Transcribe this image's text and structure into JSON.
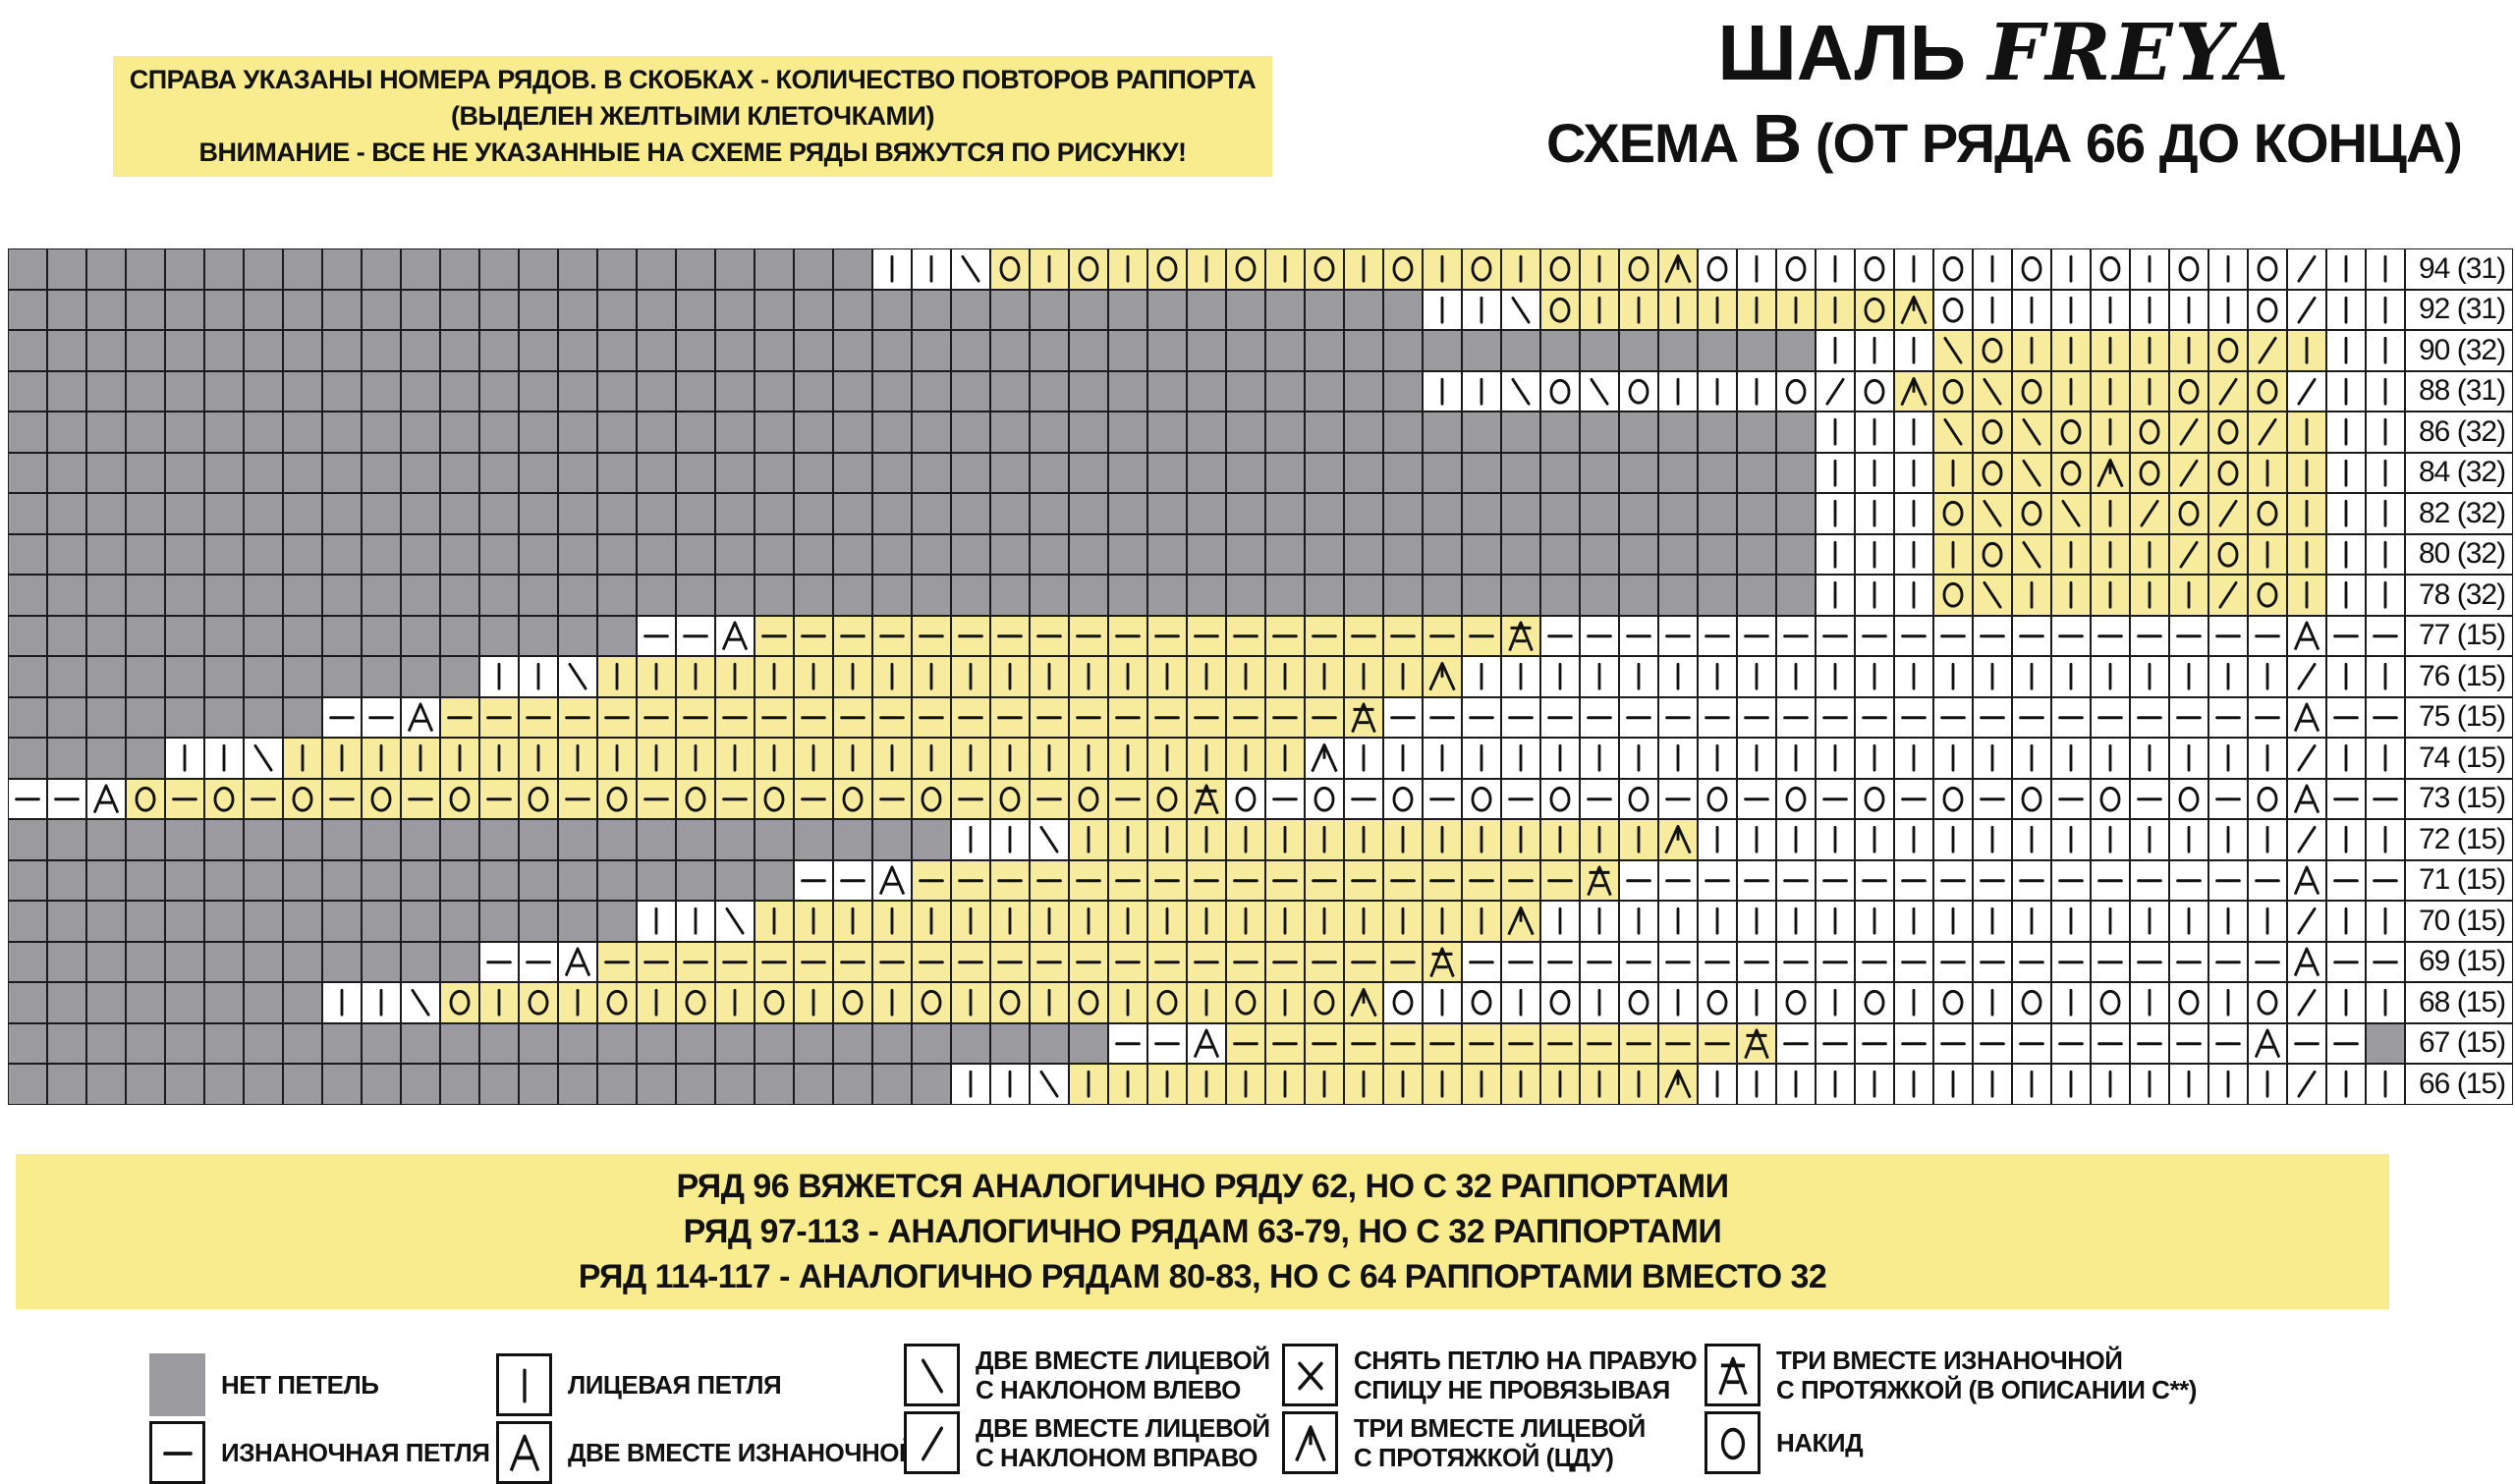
{
  "title": {
    "shawl_prefix": "ШАЛЬ ",
    "shawl_name": "FREYA",
    "scheme_pre": "СХЕМА ",
    "scheme_letter": "В",
    "scheme_post": " (ОТ РЯДА 66 ДО КОНЦА)"
  },
  "note_top": {
    "lines": [
      "СПРАВА УКАЗАНЫ НОМЕРА РЯДОВ. В СКОБКАХ - КОЛИЧЕСТВО ПОВТОРОВ РАППОРТА",
      "(ВЫДЕЛЕН ЖЕЛТЫМИ КЛЕТОЧКАМИ)",
      "ВНИМАНИЕ - ВСЕ НЕ УКАЗАННЫЕ НА СХЕМЕ РЯДЫ ВЯЖУТСЯ ПО РИСУНКУ!"
    ]
  },
  "note_bottom": {
    "lines": [
      "РЯД 96 ВЯЖЕТСЯ АНАЛОГИЧНО РЯДУ 62, НО С 32 РАППОРТАМИ",
      "РЯД 97-113 - АНАЛОГИЧНО РЯДАМ 63-79, НО С 32 РАППОРТАМИ",
      "РЯД 114-117 - АНАЛОГИЧНО РЯДАМ 80-83, НО С 64 РАППОРТАМИ ВМЕСТО 32"
    ]
  },
  "colors": {
    "rapport_yellow": "#f7eb9e",
    "note_yellow": "#f8ec8e",
    "no_stitch_gray": "#9b9a9e",
    "grid_line": "#1b1b1b"
  },
  "chart_data": {
    "type": "table",
    "description": "Lace knitting chart, schema B of shawl FREYA, rows 66-94. Each row: 61 cells left-to-right plus row label. Symbols: G=no-stitch(gray), k=knit, p=purl, o=yarn-over, l=k2tog-left, r=k2tog-right, a=p2tog, c=sl1-k2tog-psso(CDD), e=p3tog-with-slip, x=slip-stitch. 'yellow' = inclusive column range of the highlighted rapport.",
    "columns": 61,
    "symbol_key": {
      "G": "no-stitch",
      "k": "knit",
      "p": "purl",
      "o": "yarn-over",
      "l": "k2tog-left-leaning",
      "r": "k2tog-right-leaning",
      "a": "p2tog",
      "c": "cdd-3tog-knit",
      "e": "p3tog-with-slip",
      "x": "slip-stitch"
    },
    "rows": [
      {
        "label": "94 (31)",
        "yellow": [
          25,
          42
        ],
        "cells": "GGGGGGGGGGGGGGGGGGGGGGkklokokokokokokokokocokokokokokokokorkk"
      },
      {
        "label": "92 (31)",
        "yellow": [
          39,
          48
        ],
        "cells": "GGGGGGGGGGGGGGGGGGGGGGGGGGGGGGGGGGGGkklokkkkkkkocokkkkkkkorkk"
      },
      {
        "label": "90 (32)",
        "yellow": [
          49,
          58
        ],
        "cells": "GGGGGGGGGGGGGGGGGGGGGGGGGGGGGGGGGGGGGGGGGGGGGGkkklokkkkkorkkk"
      },
      {
        "label": "88 (31)",
        "yellow": [
          48,
          57
        ],
        "cells": "GGGGGGGGGGGGGGGGGGGGGGGGGGGGGGGGGGGGkklolokkkorocolokkkororkk"
      },
      {
        "label": "86 (32)",
        "yellow": [
          49,
          58
        ],
        "cells": "GGGGGGGGGGGGGGGGGGGGGGGGGGGGGGGGGGGGGGGGGGGGGGkkklolokororkkk"
      },
      {
        "label": "84 (32)",
        "yellow": [
          49,
          58
        ],
        "cells": "GGGGGGGGGGGGGGGGGGGGGGGGGGGGGGGGGGGGGGGGGGGGGGkkkkolocorokkkk"
      },
      {
        "label": "82 (32)",
        "yellow": [
          49,
          58
        ],
        "cells": "GGGGGGGGGGGGGGGGGGGGGGGGGGGGGGGGGGGGGGGGGGGGGGkkkololkrorokkk"
      },
      {
        "label": "80 (32)",
        "yellow": [
          49,
          58
        ],
        "cells": "GGGGGGGGGGGGGGGGGGGGGGGGGGGGGGGGGGGGGGGGGGGGGGkkkkolkkkrokkkk"
      },
      {
        "label": "78 (32)",
        "yellow": [
          49,
          58
        ],
        "cells": "GGGGGGGGGGGGGGGGGGGGGGGGGGGGGGGGGGGGGGGGGGGGGGkkkolkkkkkrokkk"
      },
      {
        "label": "77 (15)",
        "yellow": [
          19,
          38
        ],
        "cells": "GGGGGGGGGGGGGGGGppapppppppppppppppppppepppppppppppppppppppapp"
      },
      {
        "label": "76 (15)",
        "yellow": [
          15,
          36
        ],
        "cells": "GGGGGGGGGGGGkklkkkkkkkkkkkkkkkkkkkkkckkkkkkkkkkkkkkkkkkkkkrkk"
      },
      {
        "label": "75 (15)",
        "yellow": [
          11,
          34
        ],
        "cells": "GGGGGGGGppapppppppppppppppppppppppepppppppppppppppppppppppapp"
      },
      {
        "label": "74 (15)",
        "yellow": [
          7,
          32
        ],
        "cells": "GGGGkklkkkkkkkkkkkkkkkkkkkkkkkkkkckkkkkkkkkkkkkkkkkkkkkkkkrkk"
      },
      {
        "label": "73 (15)",
        "yellow": [
          3,
          30
        ],
        "cells": "ppaopopopopopopopopopopopopopoeopopopopopopopopopopopopopoapp"
      },
      {
        "label": "72 (15)",
        "yellow": [
          27,
          42
        ],
        "cells": "GGGGGGGGGGGGGGGGGGGGGGGGkklkkkkkkkkkkkkkkkckkkkkkkkkkkkkkkrkk"
      },
      {
        "label": "71 (15)",
        "yellow": [
          23,
          40
        ],
        "cells": "GGGGGGGGGGGGGGGGGGGGppapppppppppppppppppepppppppppppppppppapp"
      },
      {
        "label": "70 (15)",
        "yellow": [
          19,
          38
        ],
        "cells": "GGGGGGGGGGGGGGGGkklkkkkkkkkkkkkkkkkkkkckkkkkkkkkkkkkkkkkkkrkk"
      },
      {
        "label": "69 (15)",
        "yellow": [
          15,
          36
        ],
        "cells": "GGGGGGGGGGGGppapppppppppppppppppppppepppppppppppppppppppppapp"
      },
      {
        "label": "68 (15)",
        "yellow": [
          11,
          34
        ],
        "cells": "GGGGGGGGkklokokokokokokokokokokokocokokokokokokokokokokokorkk"
      },
      {
        "label": "67 (15)",
        "yellow": [
          31,
          44
        ],
        "cells": "GGGGGGGGGGGGGGGGGGGGGGGGGGGGppapppppppppppppeppppppppppppapp"
      },
      {
        "label": "66 (15)",
        "yellow": [
          27,
          42
        ],
        "cells": "GGGGGGGGGGGGGGGGGGGGGGGGkklkkkkkkkkkkkkkkkckkkkkkkkkkkkkkkrkk"
      }
    ]
  },
  "legend": {
    "groups": [
      {
        "items": [
          {
            "symbol": "G",
            "name": "no-stitch",
            "label": [
              "НЕТ ПЕТЕЛЬ"
            ]
          },
          {
            "symbol": "p",
            "name": "purl",
            "label": [
              "ИЗНАНОЧНАЯ ПЕТЛЯ"
            ]
          }
        ]
      },
      {
        "items": [
          {
            "symbol": "k",
            "name": "knit",
            "label": [
              "ЛИЦЕВАЯ ПЕТЛЯ"
            ]
          },
          {
            "symbol": "a",
            "name": "p2tog",
            "label": [
              "ДВЕ ВМЕСТЕ ИЗНАНОЧНОЙ"
            ]
          }
        ]
      },
      {
        "items": [
          {
            "symbol": "l",
            "name": "k2tog-left",
            "label": [
              "ДВЕ ВМЕСТЕ ЛИЦЕВОЙ",
              "С НАКЛОНОМ ВЛЕВО"
            ]
          },
          {
            "symbol": "r",
            "name": "k2tog-right",
            "label": [
              "ДВЕ ВМЕСТЕ ЛИЦЕВОЙ",
              "С НАКЛОНОМ ВПРАВО"
            ]
          }
        ]
      },
      {
        "items": [
          {
            "symbol": "x",
            "name": "slip-stitch",
            "label": [
              "СНЯТЬ ПЕТЛЮ НА ПРАВУЮ",
              "СПИЦУ НЕ ПРОВЯЗЫВАЯ"
            ]
          },
          {
            "symbol": "c",
            "name": "cdd",
            "label": [
              "ТРИ ВМЕСТЕ ЛИЦЕВОЙ",
              "С ПРОТЯЖКОЙ (ЦДУ)"
            ]
          }
        ]
      },
      {
        "items": [
          {
            "symbol": "e",
            "name": "p3tog-slip",
            "label": [
              "ТРИ ВМЕСТЕ ИЗНАНОЧНОЙ",
              "С ПРОТЯЖКОЙ (В ОПИСАНИИ С**)"
            ]
          },
          {
            "symbol": "o",
            "name": "yarn-over",
            "label": [
              "НАКИД"
            ]
          }
        ]
      }
    ]
  }
}
